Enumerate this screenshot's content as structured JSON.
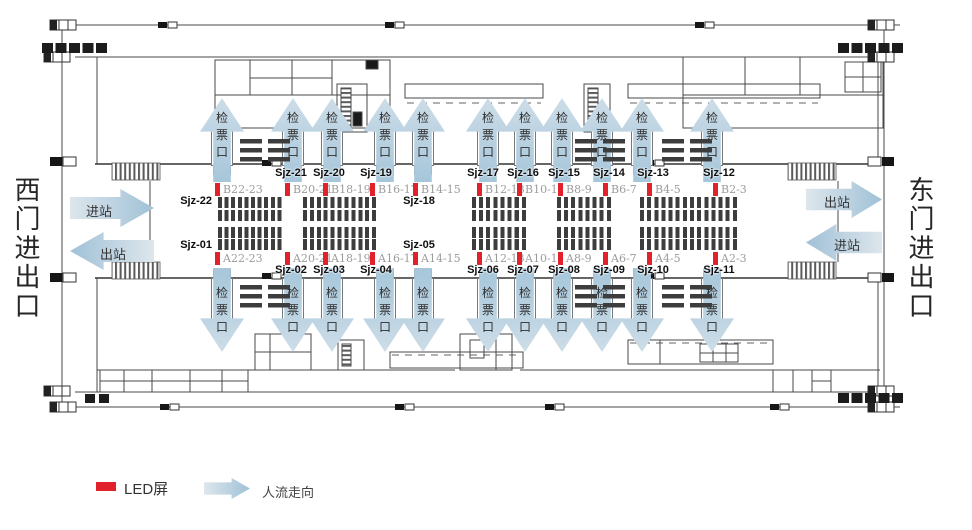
{
  "station": {
    "west_gate_label": "西门进出口",
    "east_gate_label": "东门进出口",
    "west_flow": [
      {
        "label": "进站",
        "dir": "right"
      },
      {
        "label": "出站",
        "dir": "left"
      }
    ],
    "east_flow": [
      {
        "label": "出站",
        "dir": "right"
      },
      {
        "label": "进站",
        "dir": "left"
      }
    ]
  },
  "gates": {
    "label": "检票口",
    "top_x": [
      222,
      293,
      332,
      385,
      423,
      488,
      525,
      562,
      602,
      642,
      712
    ],
    "bottom_x": [
      222,
      293,
      332,
      385,
      423,
      488,
      525,
      562,
      602,
      642,
      712
    ]
  },
  "led_screens": {
    "top": [
      {
        "id": "Sjz-22",
        "platform": "B22-23",
        "x": 215,
        "label_placement": "left-below"
      },
      {
        "id": "Sjz-21",
        "platform": "B20-21",
        "x": 285,
        "label_placement": "above"
      },
      {
        "id": "Sjz-20",
        "platform": "B18-19",
        "x": 323,
        "label_placement": "above"
      },
      {
        "id": "Sjz-19",
        "platform": "B16-17",
        "x": 370,
        "label_placement": "above"
      },
      {
        "id": "Sjz-18",
        "platform": "B14-15",
        "x": 413,
        "label_placement": "below"
      },
      {
        "id": "Sjz-17",
        "platform": "B12-13",
        "x": 477,
        "label_placement": "above"
      },
      {
        "id": "Sjz-16",
        "platform": "B10-11",
        "x": 517,
        "label_placement": "above"
      },
      {
        "id": "Sjz-15",
        "platform": "B8-9",
        "x": 558,
        "label_placement": "above"
      },
      {
        "id": "Sjz-14",
        "platform": "B6-7",
        "x": 603,
        "label_placement": "above"
      },
      {
        "id": "Sjz-13",
        "platform": "B4-5",
        "x": 647,
        "label_placement": "above"
      },
      {
        "id": "Sjz-12",
        "platform": "B2-3",
        "x": 713,
        "label_placement": "above"
      }
    ],
    "bottom": [
      {
        "id": "Sjz-01",
        "platform": "A22-23",
        "x": 215,
        "label_placement": "left-above"
      },
      {
        "id": "Sjz-02",
        "platform": "A20-21",
        "x": 285,
        "label_placement": "below"
      },
      {
        "id": "Sjz-03",
        "platform": "A18-19",
        "x": 323,
        "label_placement": "below"
      },
      {
        "id": "Sjz-04",
        "platform": "A16-17",
        "x": 370,
        "label_placement": "below"
      },
      {
        "id": "Sjz-05",
        "platform": "A14-15",
        "x": 413,
        "label_placement": "above"
      },
      {
        "id": "Sjz-06",
        "platform": "A12-13",
        "x": 477,
        "label_placement": "below"
      },
      {
        "id": "Sjz-07",
        "platform": "A10-11",
        "x": 517,
        "label_placement": "below"
      },
      {
        "id": "Sjz-08",
        "platform": "A8-9",
        "x": 558,
        "label_placement": "below"
      },
      {
        "id": "Sjz-09",
        "platform": "A6-7",
        "x": 603,
        "label_placement": "below"
      },
      {
        "id": "Sjz-10",
        "platform": "A4-5",
        "x": 647,
        "label_placement": "below"
      },
      {
        "id": "Sjz-11",
        "platform": "A2-3",
        "x": 713,
        "label_placement": "below"
      }
    ]
  },
  "seating": [
    {
      "x": 218,
      "width": 66,
      "cols": 10
    },
    {
      "x": 303,
      "width": 76,
      "cols": 11
    },
    {
      "x": 472,
      "width": 57,
      "cols": 8
    },
    {
      "x": 557,
      "width": 57,
      "cols": 8
    },
    {
      "x": 640,
      "width": 100,
      "cols": 14
    }
  ],
  "benches": {
    "top_y": 139,
    "bottom_y": 285,
    "x": [
      240,
      268,
      575,
      603,
      662,
      690
    ]
  },
  "legend": {
    "led_label": "LED屏",
    "flow_label": "人流走向"
  },
  "colors": {
    "led_red": "#e1222a",
    "flow_light": "#dde6ec",
    "flow_dark": "#a0c1d7"
  }
}
